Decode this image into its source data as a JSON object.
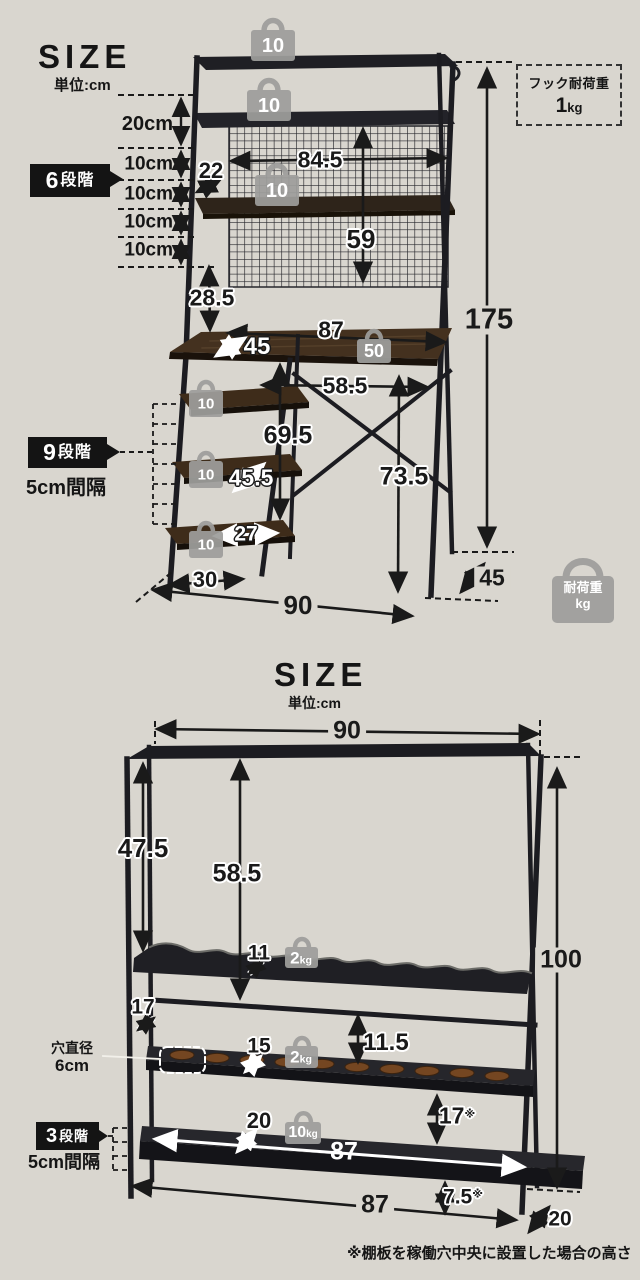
{
  "colors": {
    "background": "#d9d6cf",
    "frame": "#1c1c21",
    "wood": "#44311f",
    "bag_gray": "#9e9e9c",
    "label_bg": "#141414"
  },
  "top": {
    "title": "SIZE",
    "unit": "単位:cm",
    "hook_box": {
      "title": "フック耐荷重",
      "value": "1",
      "unit": "kg"
    },
    "left_measures": [
      "20cm",
      "10cm",
      "10cm",
      "10cm",
      "10cm"
    ],
    "step_labels": {
      "six_num": "6",
      "six_txt": "段階",
      "nine_num": "9",
      "nine_txt": "段階",
      "nine_sub": "5cm間隔"
    },
    "dims": {
      "hutch_gap": "22",
      "mesh_width": "84.5",
      "mesh_height": "59",
      "hutch_to_desk": "28.5",
      "total_height": "175",
      "desk_width": "87",
      "desk_depth": "45",
      "knee_width": "58.5",
      "knee_height": "69.5",
      "desk_height": "73.5",
      "side_diag": "45.5",
      "side_width": "27",
      "side_depth": "30",
      "floor_width": "90",
      "floor_depth": "45"
    },
    "weights": {
      "shelf": "10",
      "desk": "50"
    },
    "load_bag": {
      "line1": "耐荷重",
      "line2": "kg"
    }
  },
  "bottom": {
    "title": "SIZE",
    "unit": "単位:cm",
    "dims": {
      "width": "90",
      "front_height": "47.5",
      "inner_height": "58.5",
      "shelf1_depth": "11",
      "rail_gap": "17",
      "shelf2_depth": "15",
      "gap_rail_shelf2": "11.5",
      "gap_shelf2_shelf3": "17",
      "shelf3_depth": "20",
      "shelf_width": "87",
      "bottom_width": "87",
      "foot_height": "7.5",
      "depth": "20",
      "total_height": "100"
    },
    "note_mark": "※",
    "hole_label": {
      "line1": "穴直径",
      "line2": "6cm"
    },
    "step_labels": {
      "three_num": "3",
      "three_txt": "段階",
      "three_sub": "5cm間隔"
    },
    "weights": {
      "shelf1_num": "2",
      "shelf1_unit": "kg",
      "shelf2_num": "2",
      "shelf2_unit": "kg",
      "shelf3_num": "10",
      "shelf3_unit": "kg"
    },
    "footnote": "※棚板を稼働穴中央に設置した場合の高さ"
  }
}
